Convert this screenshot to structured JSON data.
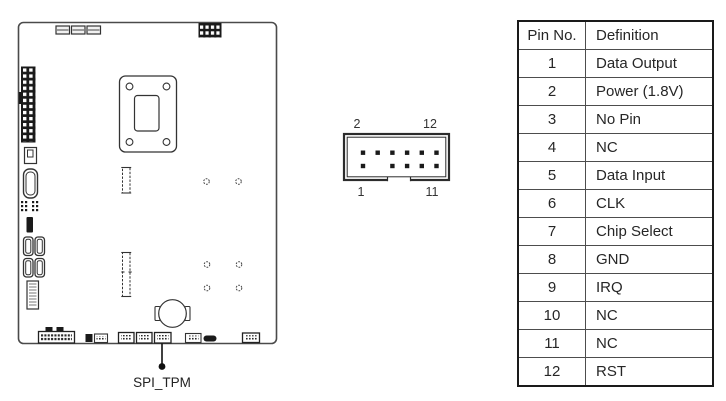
{
  "diagram": {
    "board_label": "SPI_TPM"
  },
  "connector": {
    "pin_labels": {
      "top_left": "2",
      "top_right": "12",
      "bottom_left": "1",
      "bottom_right": "11"
    }
  },
  "pin_table": {
    "headers": [
      "Pin No.",
      "Definition"
    ],
    "rows": [
      {
        "pin": "1",
        "definition": "Data Output"
      },
      {
        "pin": "2",
        "definition": "Power (1.8V)"
      },
      {
        "pin": "3",
        "definition": "No Pin"
      },
      {
        "pin": "4",
        "definition": "NC"
      },
      {
        "pin": "5",
        "definition": "Data Input"
      },
      {
        "pin": "6",
        "definition": "CLK"
      },
      {
        "pin": "7",
        "definition": "Chip Select"
      },
      {
        "pin": "8",
        "definition": "GND"
      },
      {
        "pin": "9",
        "definition": "IRQ"
      },
      {
        "pin": "10",
        "definition": "NC"
      },
      {
        "pin": "11",
        "definition": "NC"
      },
      {
        "pin": "12",
        "definition": "RST"
      }
    ]
  },
  "colors": {
    "line": "#3a3a3a",
    "dark_fill": "#1a1a1a",
    "text": "#2a2a2a",
    "background": "#ffffff"
  }
}
